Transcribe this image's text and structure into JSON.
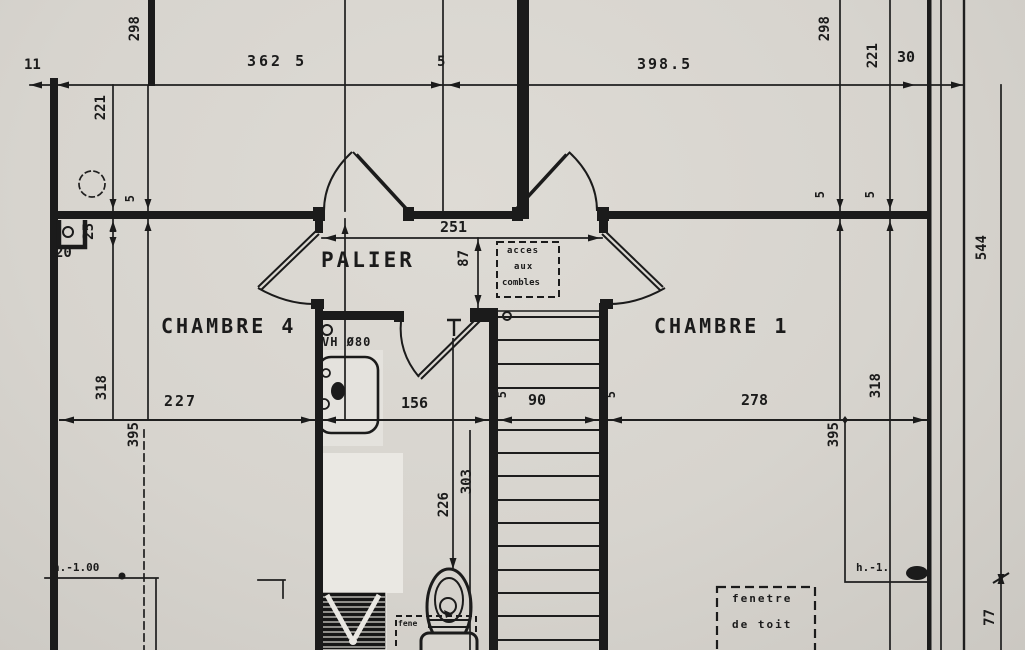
{
  "page": {
    "kind_label": ""
  },
  "colors": {
    "paper": "#d7d4ce",
    "ink": "#1b1b1b"
  },
  "rooms": {
    "palier": "PALIER",
    "chambre4": "CHAMBRE 4",
    "chambre1": "CHAMBRE 1"
  },
  "labels": [
    {
      "id": "dim-11",
      "t": "11",
      "x": 24,
      "y": 58,
      "s": 14
    },
    {
      "id": "dim-362-5",
      "t": "362 5",
      "x": 247,
      "y": 54,
      "s": 15,
      "ls": 3
    },
    {
      "id": "dim-5-top",
      "t": "5",
      "x": 437,
      "y": 55,
      "s": 14
    },
    {
      "id": "dim-398-5",
      "t": "398.5",
      "x": 637,
      "y": 57,
      "s": 15,
      "ls": 2
    },
    {
      "id": "dim-30",
      "t": "30",
      "x": 897,
      "y": 50,
      "s": 15
    },
    {
      "id": "dim-298-left",
      "t": "298",
      "x": 128,
      "y": 16,
      "s": 14,
      "v": 1
    },
    {
      "id": "dim-221-left",
      "t": "221",
      "x": 94,
      "y": 95,
      "s": 14,
      "v": 1
    },
    {
      "id": "dim-298-right",
      "t": "298",
      "x": 818,
      "y": 16,
      "s": 14,
      "v": 1
    },
    {
      "id": "dim-221-right",
      "t": "221",
      "x": 866,
      "y": 43,
      "s": 14,
      "v": 1
    },
    {
      "id": "dim-5-wall-left",
      "t": "5",
      "x": 124,
      "y": 195,
      "s": 12,
      "v": 1
    },
    {
      "id": "dim-25",
      "t": "25",
      "x": 82,
      "y": 223,
      "s": 14,
      "v": 1
    },
    {
      "id": "dim-20",
      "t": "20",
      "x": 55,
      "y": 246,
      "s": 14
    },
    {
      "id": "dim-5-wall-right-a",
      "t": "5",
      "x": 814,
      "y": 191,
      "s": 12,
      "v": 1
    },
    {
      "id": "dim-5-wall-right-b",
      "t": "5",
      "x": 864,
      "y": 191,
      "s": 12,
      "v": 1
    },
    {
      "id": "dim-251",
      "t": "251",
      "x": 440,
      "y": 220,
      "s": 15
    },
    {
      "id": "dim-87",
      "t": "87",
      "x": 457,
      "y": 250,
      "s": 14,
      "v": 1
    },
    {
      "id": "room-palier",
      "t": "PALIER",
      "x": 321,
      "y": 250,
      "s": 21,
      "ls": 3
    },
    {
      "id": "label-acces-1",
      "t": "acces",
      "x": 507,
      "y": 247,
      "s": 9,
      "ls": 1
    },
    {
      "id": "label-acces-2",
      "t": "aux",
      "x": 514,
      "y": 263,
      "s": 9,
      "ls": 1
    },
    {
      "id": "label-acces-3",
      "t": "combles",
      "x": 502,
      "y": 279,
      "s": 9
    },
    {
      "id": "room-chambre-4",
      "t": "CHAMBRE 4",
      "x": 161,
      "y": 316,
      "s": 20,
      "ls": 3
    },
    {
      "id": "room-chambre-1",
      "t": "CHAMBRE 1",
      "x": 654,
      "y": 316,
      "s": 20,
      "ls": 3
    },
    {
      "id": "label-vh",
      "t": "VH Ø80",
      "x": 322,
      "y": 336,
      "s": 12,
      "ls": 1
    },
    {
      "id": "dim-318-left",
      "t": "318",
      "x": 95,
      "y": 375,
      "s": 14,
      "v": 1
    },
    {
      "id": "dim-227",
      "t": "227",
      "x": 164,
      "y": 394,
      "s": 15,
      "ls": 2
    },
    {
      "id": "dim-156",
      "t": "156",
      "x": 401,
      "y": 396,
      "s": 15
    },
    {
      "id": "dim-5-stair-left",
      "t": "5",
      "x": 496,
      "y": 391,
      "s": 12,
      "v": 1
    },
    {
      "id": "dim-90",
      "t": "90",
      "x": 528,
      "y": 393,
      "s": 15
    },
    {
      "id": "dim-5-stair-right",
      "t": "5",
      "x": 605,
      "y": 391,
      "s": 12,
      "v": 1
    },
    {
      "id": "dim-278",
      "t": "278",
      "x": 741,
      "y": 393,
      "s": 15
    },
    {
      "id": "dim-318-right",
      "t": "318",
      "x": 869,
      "y": 373,
      "s": 14,
      "v": 1
    },
    {
      "id": "dim-395-left",
      "t": "395",
      "x": 127,
      "y": 422,
      "s": 14,
      "v": 1
    },
    {
      "id": "dim-395-right",
      "t": "395",
      "x": 827,
      "y": 422,
      "s": 14,
      "v": 1
    },
    {
      "id": "dim-303",
      "t": "303",
      "x": 460,
      "y": 469,
      "s": 14,
      "v": 1
    },
    {
      "id": "dim-226",
      "t": "226",
      "x": 437,
      "y": 492,
      "s": 14,
      "v": 1
    },
    {
      "id": "dim-544",
      "t": "544",
      "x": 975,
      "y": 235,
      "s": 14,
      "v": 1
    },
    {
      "id": "dim-77",
      "t": "77",
      "x": 983,
      "y": 609,
      "s": 14,
      "v": 1
    },
    {
      "id": "label-h-left",
      "t": "h.-1.00",
      "x": 53,
      "y": 562,
      "s": 11
    },
    {
      "id": "label-h-right",
      "t": "h.-1.",
      "x": 856,
      "y": 562,
      "s": 11
    },
    {
      "id": "label-fene-partial",
      "t": "fene",
      "x": 398,
      "y": 620,
      "s": 8
    },
    {
      "id": "label-fenetre-1",
      "t": "fenetre",
      "x": 732,
      "y": 593,
      "s": 11,
      "ls": 2
    },
    {
      "id": "label-fenetre-2",
      "t": "de toit",
      "x": 732,
      "y": 619,
      "s": 11,
      "ls": 2
    }
  ]
}
